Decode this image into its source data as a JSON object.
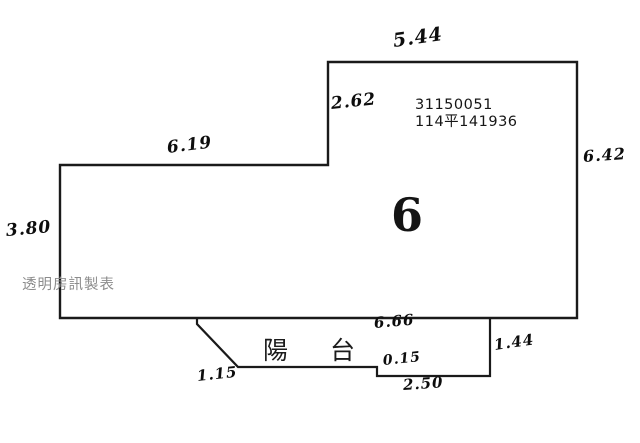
{
  "plan": {
    "unit_number": "6",
    "parcel_id": "31150051",
    "registration_no": "114平141936",
    "balcony_label": "陽台",
    "watermark": "透明房訊製表",
    "measurements": {
      "top": "5.44",
      "upper_left": "2.62",
      "left_upper": "6.19",
      "left": "3.80",
      "right": "6.42",
      "balcony_top": "6.66",
      "balcony_diagonal": "1.15",
      "balcony_step": "0.15",
      "balcony_bottom": "2.50",
      "balcony_right": "1.44"
    },
    "colors": {
      "line": "#1a1a1a",
      "ink": "#0d0d0d",
      "watermark_gray": "#8c8c8c",
      "background": "#ffffff"
    }
  }
}
